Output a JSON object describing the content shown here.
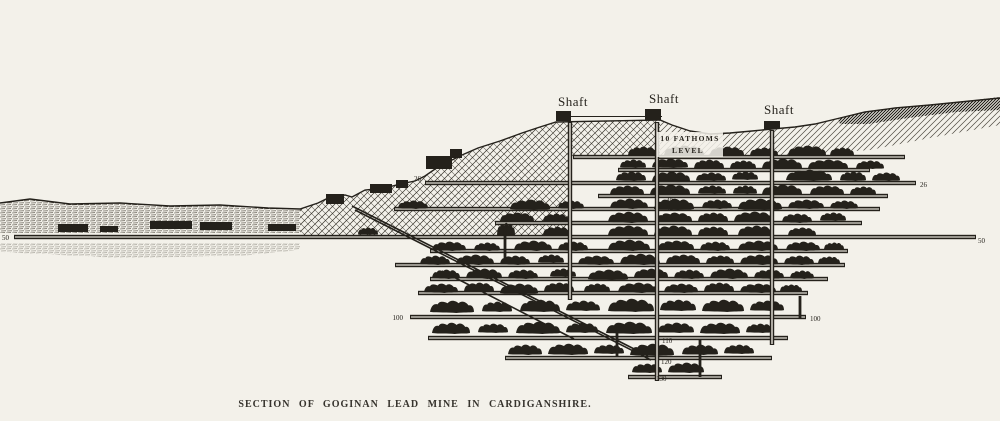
{
  "caption": "SECTION OF GOGINAN LEAD MINE IN CARDIGANSHIRE.",
  "shaft_labels": [
    {
      "text": "Shaft"
    },
    {
      "text": "Shaft"
    },
    {
      "text": "Shaft"
    }
  ],
  "fathoms_label": {
    "line1": "10 FATHOMS",
    "line2": "LEVEL"
  },
  "depth_labels": [
    {
      "text": "26",
      "x": 421,
      "y": 181,
      "anchor": "end",
      "size": 7
    },
    {
      "text": "26",
      "x": 920,
      "y": 187,
      "anchor": "start",
      "size": 7
    },
    {
      "text": "50",
      "x": 2,
      "y": 240,
      "anchor": "start",
      "size": 7
    },
    {
      "text": "50",
      "x": 978,
      "y": 243,
      "anchor": "start",
      "size": 7
    },
    {
      "text": "16",
      "x": 663,
      "y": 167,
      "anchor": "start",
      "size": 6
    },
    {
      "text": "40",
      "x": 666,
      "y": 203,
      "anchor": "start",
      "size": 5.5
    },
    {
      "text": "42",
      "x": 666,
      "y": 210,
      "anchor": "start",
      "size": 5.5
    },
    {
      "text": "100",
      "x": 403,
      "y": 320,
      "anchor": "end",
      "size": 7
    },
    {
      "text": "100",
      "x": 810,
      "y": 321,
      "anchor": "start",
      "size": 7
    },
    {
      "text": "110",
      "x": 662,
      "y": 343,
      "anchor": "start",
      "size": 6
    },
    {
      "text": "120",
      "x": 661,
      "y": 364,
      "anchor": "start",
      "size": 6.5
    },
    {
      "text": "130",
      "x": 656,
      "y": 381,
      "anchor": "start",
      "size": 6.5
    }
  ],
  "colors": {
    "ink": "#24211b",
    "paper": "#f3f1ea",
    "gallery": "#e9e6dd"
  },
  "diagram": {
    "levels": [
      [
        573,
        905,
        157
      ],
      [
        618,
        870,
        170
      ],
      [
        425,
        916,
        183
      ],
      [
        598,
        888,
        196
      ],
      [
        394,
        880,
        209
      ],
      [
        495,
        862,
        223
      ],
      [
        14,
        976,
        237
      ],
      [
        430,
        848,
        251
      ],
      [
        395,
        845,
        265
      ],
      [
        430,
        828,
        279
      ],
      [
        418,
        808,
        293
      ],
      [
        410,
        806,
        317
      ],
      [
        428,
        788,
        338
      ],
      [
        505,
        772,
        358
      ],
      [
        628,
        722,
        377
      ]
    ],
    "shafts": [
      [
        570,
        122,
        300
      ],
      [
        657,
        122,
        381
      ],
      [
        772,
        130,
        345
      ]
    ],
    "winzes": [
      [
        505,
        226,
        262
      ],
      [
        617,
        332,
        357
      ],
      [
        700,
        340,
        377
      ],
      [
        800,
        296,
        318
      ]
    ],
    "diagonals": [
      [
        352,
        206,
        648,
        356
      ],
      [
        355,
        210,
        651,
        360
      ],
      [
        442,
        271,
        574,
        339
      ]
    ],
    "buildings": [
      [
        58,
        224,
        30,
        8
      ],
      [
        100,
        226,
        18,
        6
      ],
      [
        150,
        221,
        42,
        8
      ],
      [
        200,
        222,
        32,
        8
      ],
      [
        268,
        224,
        28,
        7
      ],
      [
        326,
        194,
        18,
        10
      ],
      [
        370,
        184,
        22,
        9
      ],
      [
        396,
        180,
        12,
        8
      ],
      [
        426,
        156,
        26,
        13
      ],
      [
        450,
        149,
        12,
        9
      ],
      [
        556,
        111,
        15,
        10
      ],
      [
        645,
        109,
        16,
        11
      ],
      [
        764,
        121,
        16,
        8
      ]
    ],
    "stopes": [
      [
        628,
        146,
        30,
        10
      ],
      [
        664,
        145,
        40,
        11
      ],
      [
        710,
        146,
        34,
        10
      ],
      [
        750,
        147,
        28,
        9
      ],
      [
        788,
        145,
        38,
        11
      ],
      [
        830,
        147,
        24,
        9
      ],
      [
        620,
        159,
        26,
        9
      ],
      [
        652,
        158,
        36,
        10
      ],
      [
        694,
        159,
        30,
        10
      ],
      [
        730,
        160,
        26,
        9
      ],
      [
        762,
        158,
        40,
        11
      ],
      [
        808,
        159,
        40,
        10
      ],
      [
        856,
        160,
        28,
        9
      ],
      [
        616,
        171,
        30,
        10
      ],
      [
        652,
        171,
        38,
        11
      ],
      [
        696,
        172,
        30,
        9
      ],
      [
        732,
        171,
        26,
        9
      ],
      [
        786,
        169,
        46,
        12
      ],
      [
        840,
        171,
        26,
        10
      ],
      [
        872,
        172,
        28,
        9
      ],
      [
        610,
        185,
        34,
        10
      ],
      [
        650,
        184,
        40,
        11
      ],
      [
        698,
        185,
        28,
        9
      ],
      [
        733,
        185,
        24,
        9
      ],
      [
        762,
        184,
        40,
        11
      ],
      [
        810,
        185,
        34,
        10
      ],
      [
        850,
        186,
        26,
        9
      ],
      [
        398,
        200,
        30,
        9
      ],
      [
        510,
        199,
        40,
        11
      ],
      [
        558,
        200,
        26,
        9
      ],
      [
        610,
        198,
        38,
        11
      ],
      [
        654,
        198,
        40,
        12
      ],
      [
        702,
        199,
        30,
        10
      ],
      [
        738,
        198,
        44,
        12
      ],
      [
        788,
        199,
        36,
        10
      ],
      [
        830,
        200,
        28,
        9
      ],
      [
        500,
        212,
        34,
        10
      ],
      [
        543,
        213,
        26,
        9
      ],
      [
        608,
        211,
        40,
        12
      ],
      [
        656,
        212,
        36,
        10
      ],
      [
        698,
        212,
        30,
        10
      ],
      [
        734,
        211,
        40,
        11
      ],
      [
        782,
        213,
        30,
        10
      ],
      [
        820,
        212,
        26,
        9
      ],
      [
        358,
        227,
        20,
        8
      ],
      [
        497,
        222,
        18,
        14
      ],
      [
        543,
        226,
        28,
        10
      ],
      [
        608,
        225,
        40,
        11
      ],
      [
        654,
        225,
        38,
        11
      ],
      [
        698,
        226,
        30,
        10
      ],
      [
        738,
        225,
        36,
        11
      ],
      [
        788,
        227,
        28,
        9
      ],
      [
        432,
        241,
        34,
        10
      ],
      [
        474,
        242,
        26,
        9
      ],
      [
        514,
        240,
        38,
        11
      ],
      [
        558,
        241,
        30,
        10
      ],
      [
        608,
        239,
        42,
        12
      ],
      [
        658,
        240,
        36,
        10
      ],
      [
        700,
        241,
        30,
        10
      ],
      [
        738,
        240,
        40,
        11
      ],
      [
        786,
        241,
        34,
        10
      ],
      [
        824,
        242,
        20,
        8
      ],
      [
        420,
        255,
        30,
        10
      ],
      [
        456,
        254,
        38,
        11
      ],
      [
        500,
        255,
        30,
        10
      ],
      [
        538,
        254,
        26,
        9
      ],
      [
        578,
        255,
        36,
        10
      ],
      [
        620,
        253,
        40,
        12
      ],
      [
        666,
        254,
        34,
        10
      ],
      [
        706,
        255,
        28,
        9
      ],
      [
        740,
        254,
        38,
        11
      ],
      [
        784,
        255,
        30,
        10
      ],
      [
        818,
        256,
        22,
        8
      ],
      [
        432,
        269,
        28,
        10
      ],
      [
        466,
        268,
        36,
        11
      ],
      [
        508,
        269,
        30,
        10
      ],
      [
        550,
        268,
        26,
        9
      ],
      [
        588,
        269,
        40,
        11
      ],
      [
        634,
        268,
        34,
        10
      ],
      [
        674,
        269,
        30,
        10
      ],
      [
        710,
        268,
        38,
        11
      ],
      [
        754,
        269,
        30,
        10
      ],
      [
        790,
        270,
        24,
        9
      ],
      [
        424,
        283,
        34,
        10
      ],
      [
        464,
        282,
        30,
        10
      ],
      [
        500,
        283,
        38,
        11
      ],
      [
        544,
        282,
        30,
        10
      ],
      [
        584,
        283,
        26,
        9
      ],
      [
        618,
        282,
        40,
        11
      ],
      [
        664,
        283,
        34,
        10
      ],
      [
        704,
        282,
        30,
        10
      ],
      [
        740,
        283,
        36,
        10
      ],
      [
        780,
        284,
        22,
        8
      ],
      [
        430,
        300,
        44,
        13
      ],
      [
        482,
        301,
        30,
        11
      ],
      [
        520,
        299,
        40,
        13
      ],
      [
        566,
        300,
        34,
        11
      ],
      [
        608,
        298,
        46,
        14
      ],
      [
        660,
        299,
        36,
        12
      ],
      [
        702,
        299,
        42,
        13
      ],
      [
        750,
        300,
        34,
        11
      ],
      [
        432,
        322,
        38,
        12
      ],
      [
        478,
        323,
        30,
        10
      ],
      [
        516,
        321,
        44,
        13
      ],
      [
        566,
        322,
        32,
        11
      ],
      [
        606,
        321,
        46,
        13
      ],
      [
        658,
        322,
        36,
        11
      ],
      [
        700,
        322,
        40,
        12
      ],
      [
        746,
        323,
        28,
        10
      ],
      [
        508,
        344,
        34,
        11
      ],
      [
        548,
        343,
        40,
        12
      ],
      [
        594,
        344,
        30,
        10
      ],
      [
        630,
        343,
        44,
        13
      ],
      [
        682,
        344,
        36,
        11
      ],
      [
        724,
        344,
        30,
        10
      ],
      [
        632,
        363,
        30,
        10
      ],
      [
        668,
        362,
        36,
        11
      ]
    ]
  }
}
